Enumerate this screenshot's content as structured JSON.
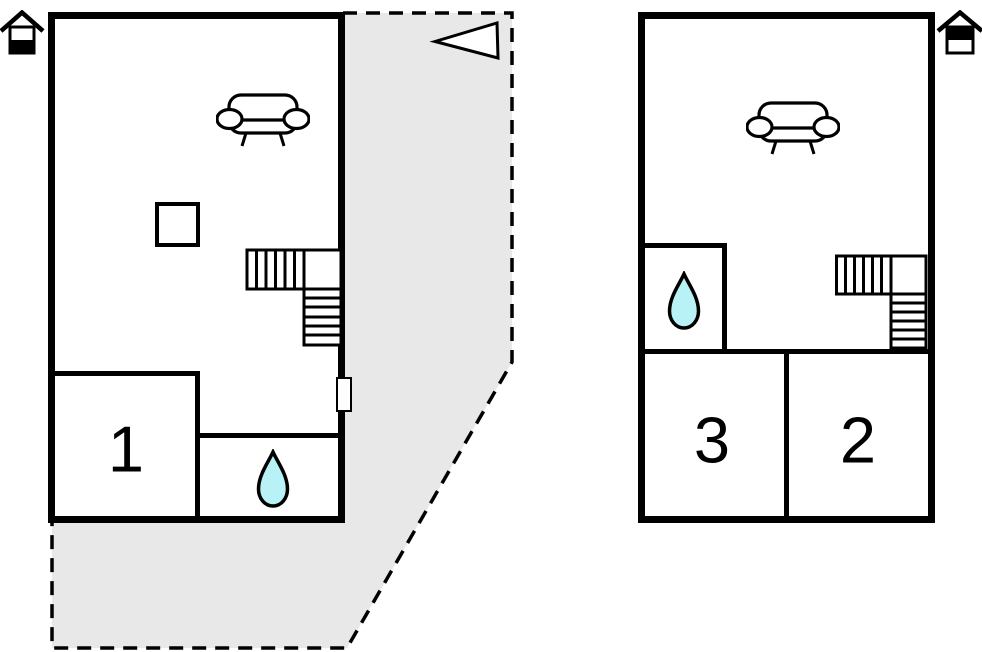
{
  "colors": {
    "background": "#ffffff",
    "wall": "#000000",
    "terrace": "#e8e8e8",
    "water": "#b8f1f6",
    "outline": "#000000",
    "door": "#ffffff"
  },
  "ground_floor": {
    "level_icon": "house-ground-floor-icon",
    "rooms": [
      {
        "label": "1"
      }
    ],
    "features": [
      "sofa",
      "side-table",
      "l-shaped-stairs",
      "bathroom-water-drop",
      "terrace-door",
      "terrace-area",
      "entrance-arrow"
    ]
  },
  "upper_floor": {
    "level_icon": "house-upper-floor-icon",
    "rooms": [
      {
        "label": "3"
      },
      {
        "label": "2"
      }
    ],
    "features": [
      "sofa",
      "l-shaped-stairs",
      "bathroom-water-drop"
    ]
  }
}
